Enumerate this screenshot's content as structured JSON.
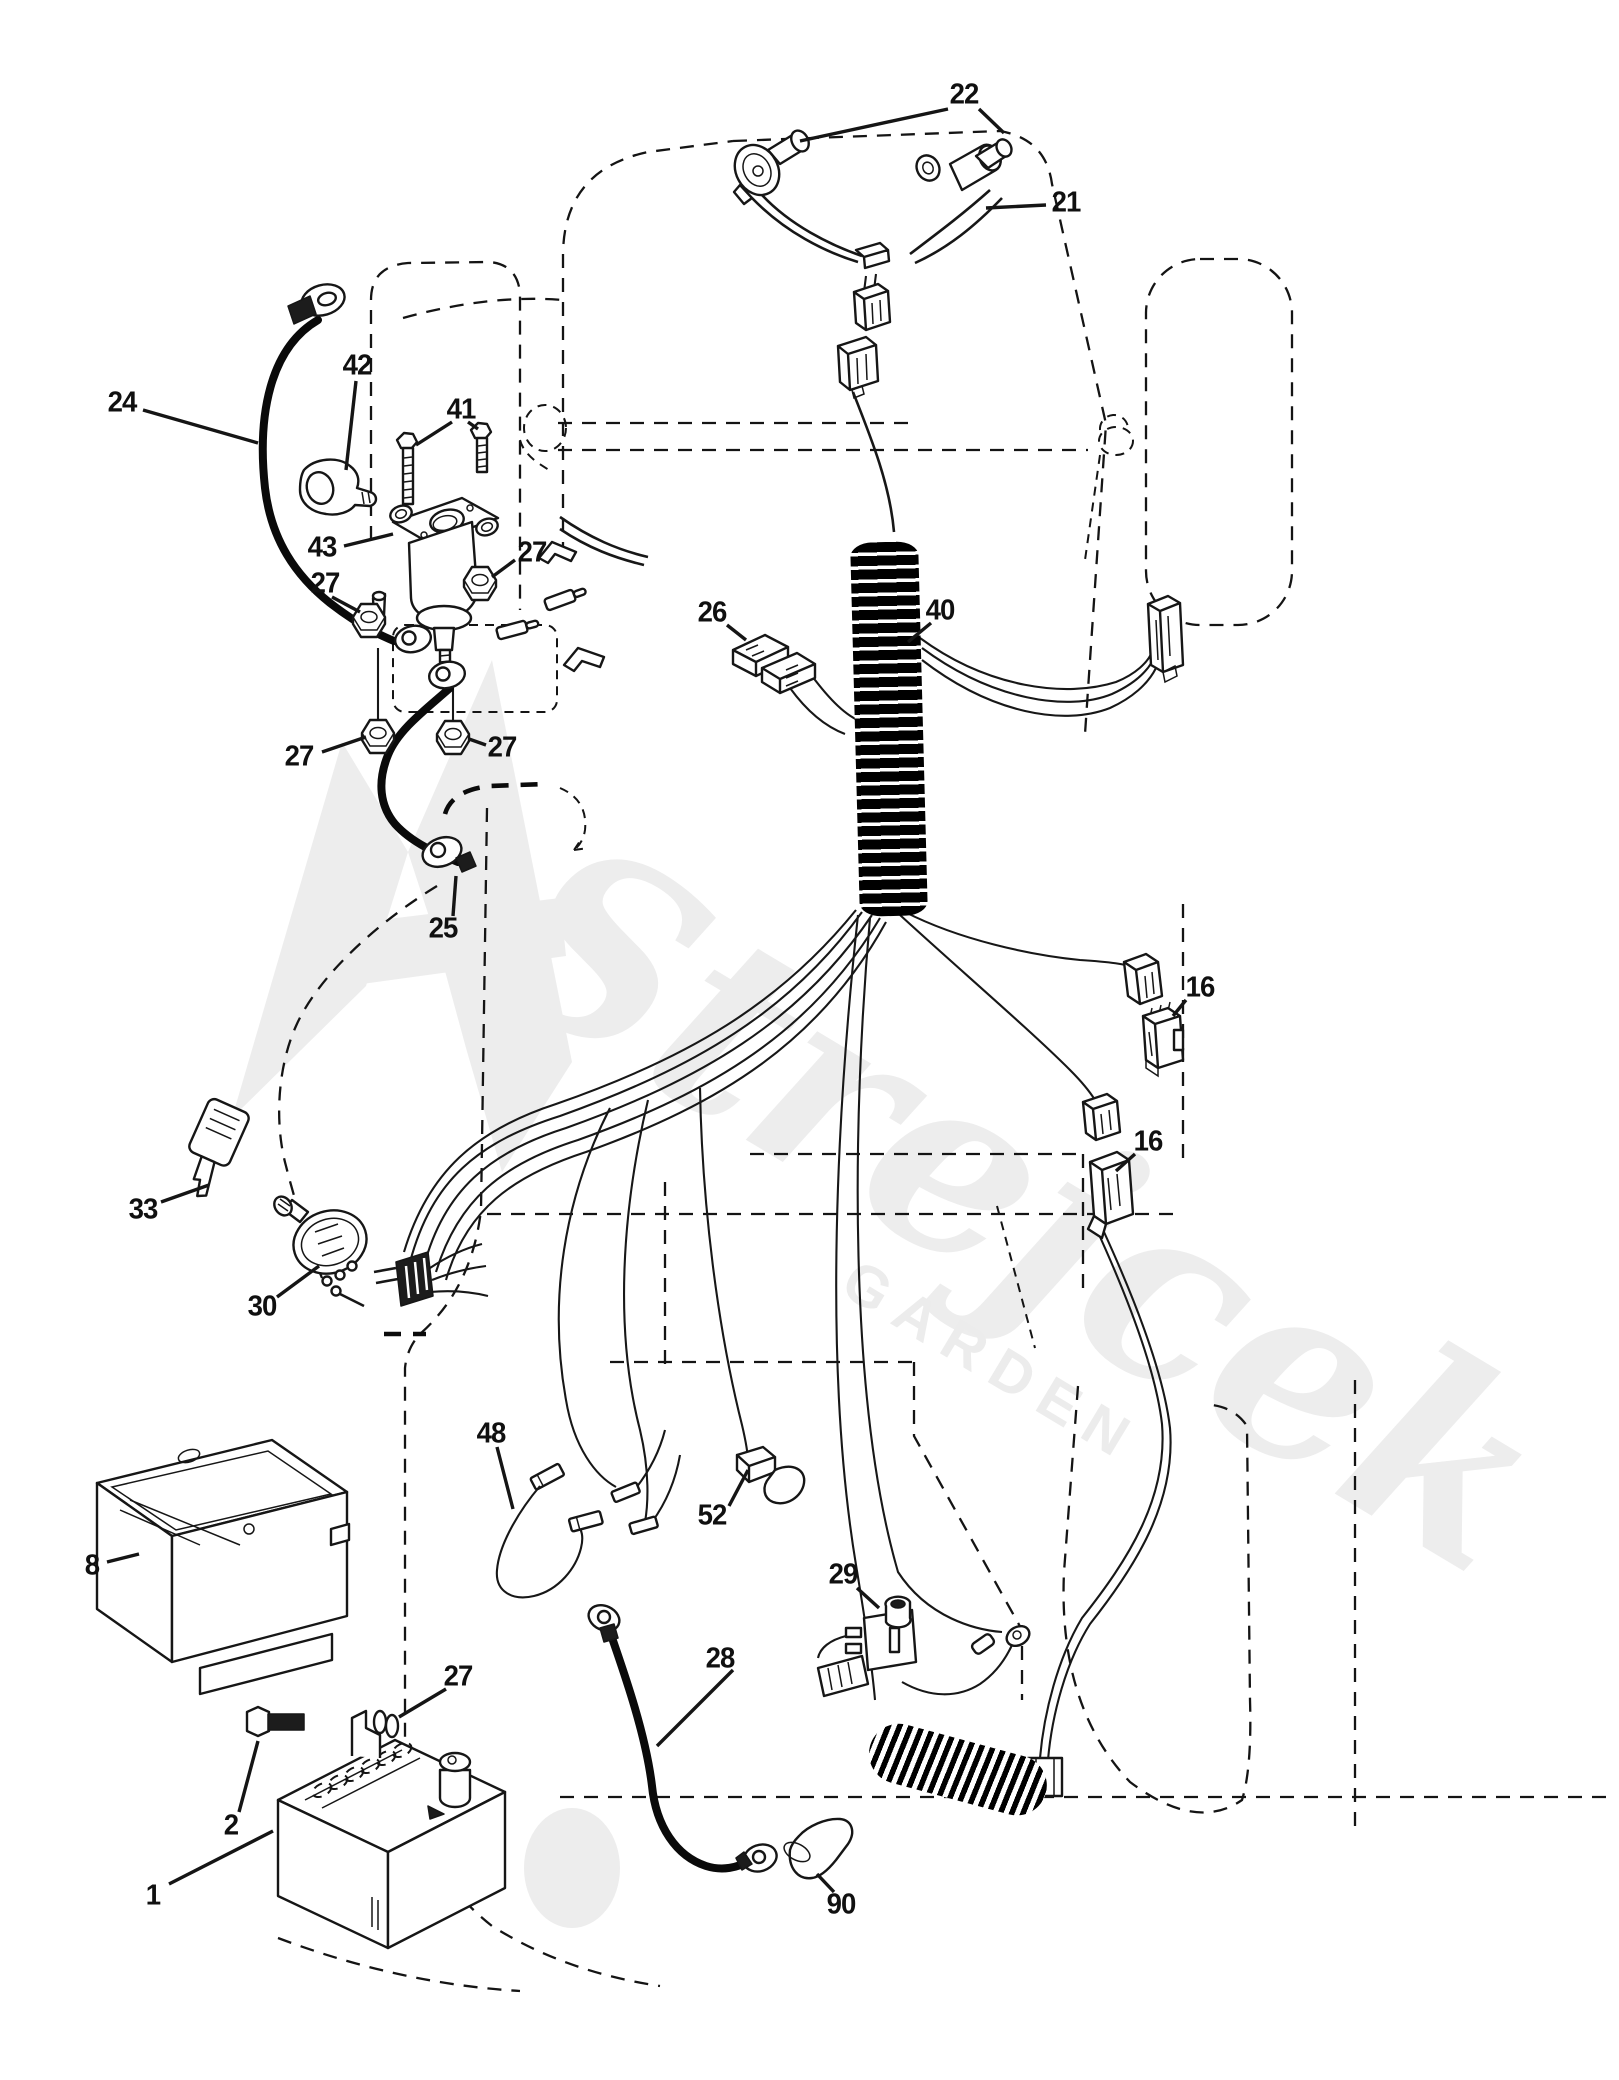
{
  "diagram": {
    "kind": "exploded-parts-diagram",
    "subject": "tractor electrical system wiring",
    "background_color": "#ffffff",
    "line_color": "#141414",
    "label_color": "#101010"
  },
  "watermark": {
    "word": "Strejcek",
    "subtext": "GARDEN",
    "color": "#ededed",
    "angle_deg": 31
  },
  "callouts": [
    {
      "label": "22",
      "name": "bulb-sockets",
      "x": 964,
      "y": 95,
      "leaders": [
        [
          948,
          109,
          800,
          141
        ],
        [
          979,
          109,
          1004,
          133
        ]
      ]
    },
    {
      "label": "21",
      "name": "headlight-harness",
      "x": 1066,
      "y": 203,
      "leaders": [
        [
          1046,
          205,
          986,
          208
        ]
      ]
    },
    {
      "label": "24",
      "name": "battery-cable",
      "x": 122,
      "y": 403,
      "leaders": [
        [
          143,
          410,
          258,
          443
        ]
      ]
    },
    {
      "label": "42",
      "name": "terminal-boot",
      "x": 357,
      "y": 366,
      "leaders": [
        [
          356,
          381,
          346,
          470
        ]
      ]
    },
    {
      "label": "41",
      "name": "hex-bolts",
      "x": 461,
      "y": 410,
      "leaders": [
        [
          452,
          422,
          416,
          445
        ],
        [
          468,
          422,
          478,
          429
        ]
      ]
    },
    {
      "label": "43",
      "name": "starter-solenoid",
      "x": 322,
      "y": 548,
      "leaders": [
        [
          344,
          546,
          393,
          534
        ]
      ]
    },
    {
      "label": "27",
      "name": "hex-nut-a",
      "x": 532,
      "y": 553,
      "leaders": [
        [
          515,
          560,
          492,
          577
        ]
      ]
    },
    {
      "label": "27",
      "name": "hex-nut-b",
      "x": 325,
      "y": 584,
      "leaders": [
        [
          332,
          597,
          360,
          612
        ]
      ]
    },
    {
      "label": "27",
      "name": "hex-nut-c",
      "x": 299,
      "y": 757,
      "leaders": [
        [
          322,
          752,
          366,
          737
        ]
      ]
    },
    {
      "label": "27",
      "name": "hex-nut-d",
      "x": 502,
      "y": 748,
      "leaders": [
        [
          486,
          745,
          469,
          739
        ]
      ]
    },
    {
      "label": "26",
      "name": "fuse",
      "x": 712,
      "y": 613,
      "leaders": [
        [
          727,
          625,
          746,
          640
        ]
      ]
    },
    {
      "label": "40",
      "name": "main-harness",
      "x": 940,
      "y": 611,
      "leaders": [
        [
          931,
          623,
          908,
          642
        ]
      ]
    },
    {
      "label": "25",
      "name": "solenoid-ground-cable",
      "x": 443,
      "y": 929,
      "leaders": [
        [
          453,
          916,
          456,
          876
        ]
      ]
    },
    {
      "label": "16",
      "name": "interlock-connector-upper",
      "x": 1200,
      "y": 988,
      "leaders": [
        [
          1186,
          1000,
          1173,
          1016
        ]
      ]
    },
    {
      "label": "16",
      "name": "interlock-connector-lower",
      "x": 1148,
      "y": 1142,
      "leaders": [
        [
          1135,
          1154,
          1116,
          1171
        ]
      ]
    },
    {
      "label": "33",
      "name": "ignition-key",
      "x": 143,
      "y": 1210,
      "leaders": [
        [
          161,
          1202,
          209,
          1185
        ]
      ]
    },
    {
      "label": "30",
      "name": "ignition-switch",
      "x": 262,
      "y": 1307,
      "leaders": [
        [
          277,
          1297,
          319,
          1266
        ]
      ]
    },
    {
      "label": "48",
      "name": "jumper-wire",
      "x": 491,
      "y": 1434,
      "leaders": [
        [
          497,
          1447,
          513,
          1509
        ]
      ]
    },
    {
      "label": "52",
      "name": "connector-cap",
      "x": 712,
      "y": 1516,
      "leaders": [
        [
          729,
          1506,
          748,
          1470
        ]
      ]
    },
    {
      "label": "8",
      "name": "battery-box",
      "x": 92,
      "y": 1566,
      "leaders": [
        [
          107,
          1562,
          139,
          1554
        ]
      ]
    },
    {
      "label": "29",
      "name": "safety-switch",
      "x": 843,
      "y": 1575,
      "leaders": [
        [
          857,
          1588,
          879,
          1608
        ]
      ]
    },
    {
      "label": "28",
      "name": "ground-cable",
      "x": 720,
      "y": 1659,
      "leaders": [
        [
          733,
          1670,
          657,
          1746
        ]
      ]
    },
    {
      "label": "27",
      "name": "hex-nut-battery",
      "x": 458,
      "y": 1677,
      "leaders": [
        [
          446,
          1689,
          399,
          1717
        ]
      ]
    },
    {
      "label": "2",
      "name": "battery-bolt",
      "x": 231,
      "y": 1826,
      "leaders": [
        [
          239,
          1812,
          258,
          1741
        ]
      ]
    },
    {
      "label": "1",
      "name": "battery",
      "x": 153,
      "y": 1896,
      "leaders": [
        [
          169,
          1884,
          273,
          1831
        ]
      ]
    },
    {
      "label": "90",
      "name": "terminal-protector",
      "x": 841,
      "y": 1905,
      "leaders": [
        [
          834,
          1892,
          817,
          1874
        ]
      ]
    }
  ]
}
